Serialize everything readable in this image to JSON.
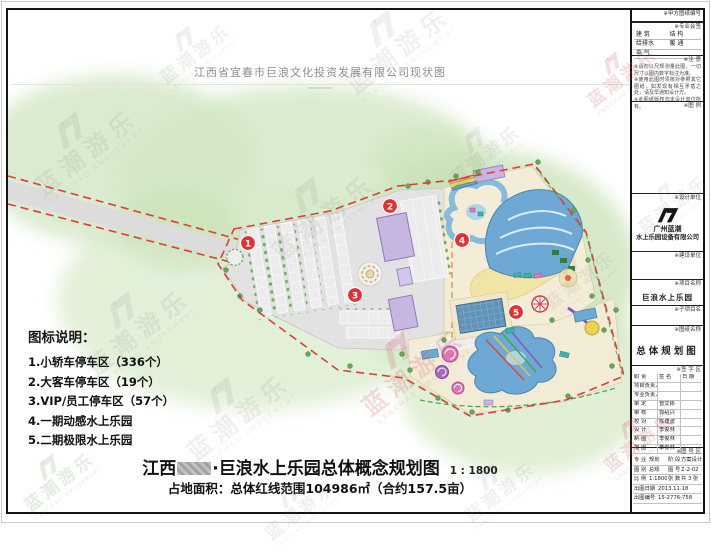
{
  "watermark": {
    "cn": "蓝潮游乐",
    "en": "LANCHAO AMUSEMENT"
  },
  "survey_header": {
    "title": "江西省宜春市巨浪文化投资发展有限公司现状图"
  },
  "legend": {
    "title": "图标说明：",
    "items": [
      "1.小轿车停车区（336个）",
      "2.大客车停车区（19个）",
      "3.VIP/员工停车区（57个）",
      "4.一期动感水上乐园",
      "5.二期极限水上乐园"
    ]
  },
  "plan": {
    "markers": [
      "1",
      "2",
      "3",
      "4",
      "5"
    ]
  },
  "footer": {
    "region": "江西",
    "title_rest": "·巨浪水上乐园总体概念规划图",
    "scale": "1 : 1800",
    "area_line": "占地面积：总体红线范围104986㎡（合约157.5亩）"
  },
  "titleblock": {
    "client_no_label": "※甲方图纸编号",
    "cosign": {
      "label": "※专业会签",
      "cells": [
        "建 筑",
        "结 构",
        "给排水",
        "暖 通",
        "电 气",
        ""
      ]
    },
    "notes": {
      "label": "※注 意",
      "lines": [
        "※请勿以尺规测量此图，一切尺寸以图内数字标注为准。",
        "※使用此图时须核对参照其它图纸，如发现有相互矛盾之处，请及早通知设计方。",
        "※此图纸版权归本设计单位所有。"
      ]
    },
    "legend_label": "※图 例",
    "design_unit": {
      "label": "※设计单位",
      "name1": "广州蓝潮",
      "name2": "水上乐园设备有限公司"
    },
    "build_unit_label": "※建设单位",
    "project": {
      "label": "※项目名称",
      "name": "巨浪水上乐园"
    },
    "subproject_label": "※子项目名",
    "drawing": {
      "label": "※图纸名称",
      "name": "总体规划图"
    },
    "signature": {
      "label": "※签 字 区",
      "cols": [
        "职 责",
        "签 名",
        "日 期"
      ],
      "rows": [
        {
          "role": "项目负责人",
          "name": ""
        },
        {
          "role": "专业负责人",
          "name": ""
        },
        {
          "role": "审 定",
          "name": "曾文彬"
        },
        {
          "role": "审 核",
          "name": "郭绍兴"
        },
        {
          "role": "校 对",
          "name": "陈建波"
        },
        {
          "role": "设 计",
          "name": "李俊林"
        },
        {
          "role": "制 图",
          "name": "李俊林"
        },
        {
          "role": "描 图",
          "name": "李俊林"
        }
      ]
    },
    "numblock": {
      "label": "※图 号 区",
      "r1": {
        "k1": "专 业",
        "v1": "规划",
        "k2": "阶 段",
        "v2": "方案设计"
      },
      "r2": {
        "k1": "图 别",
        "v1": "总规",
        "k2": "图 号",
        "v2": "Z-2-02"
      },
      "r3": {
        "k1": "比 例",
        "v1": "1:1800(A3)",
        "k2": "张 数",
        "v2": "共 3 张"
      },
      "r4": {
        "k": "出图日期",
        "v": "2013.11.18"
      },
      "r5": {
        "k": "出图编号",
        "v": "15-2776-758"
      }
    }
  }
}
